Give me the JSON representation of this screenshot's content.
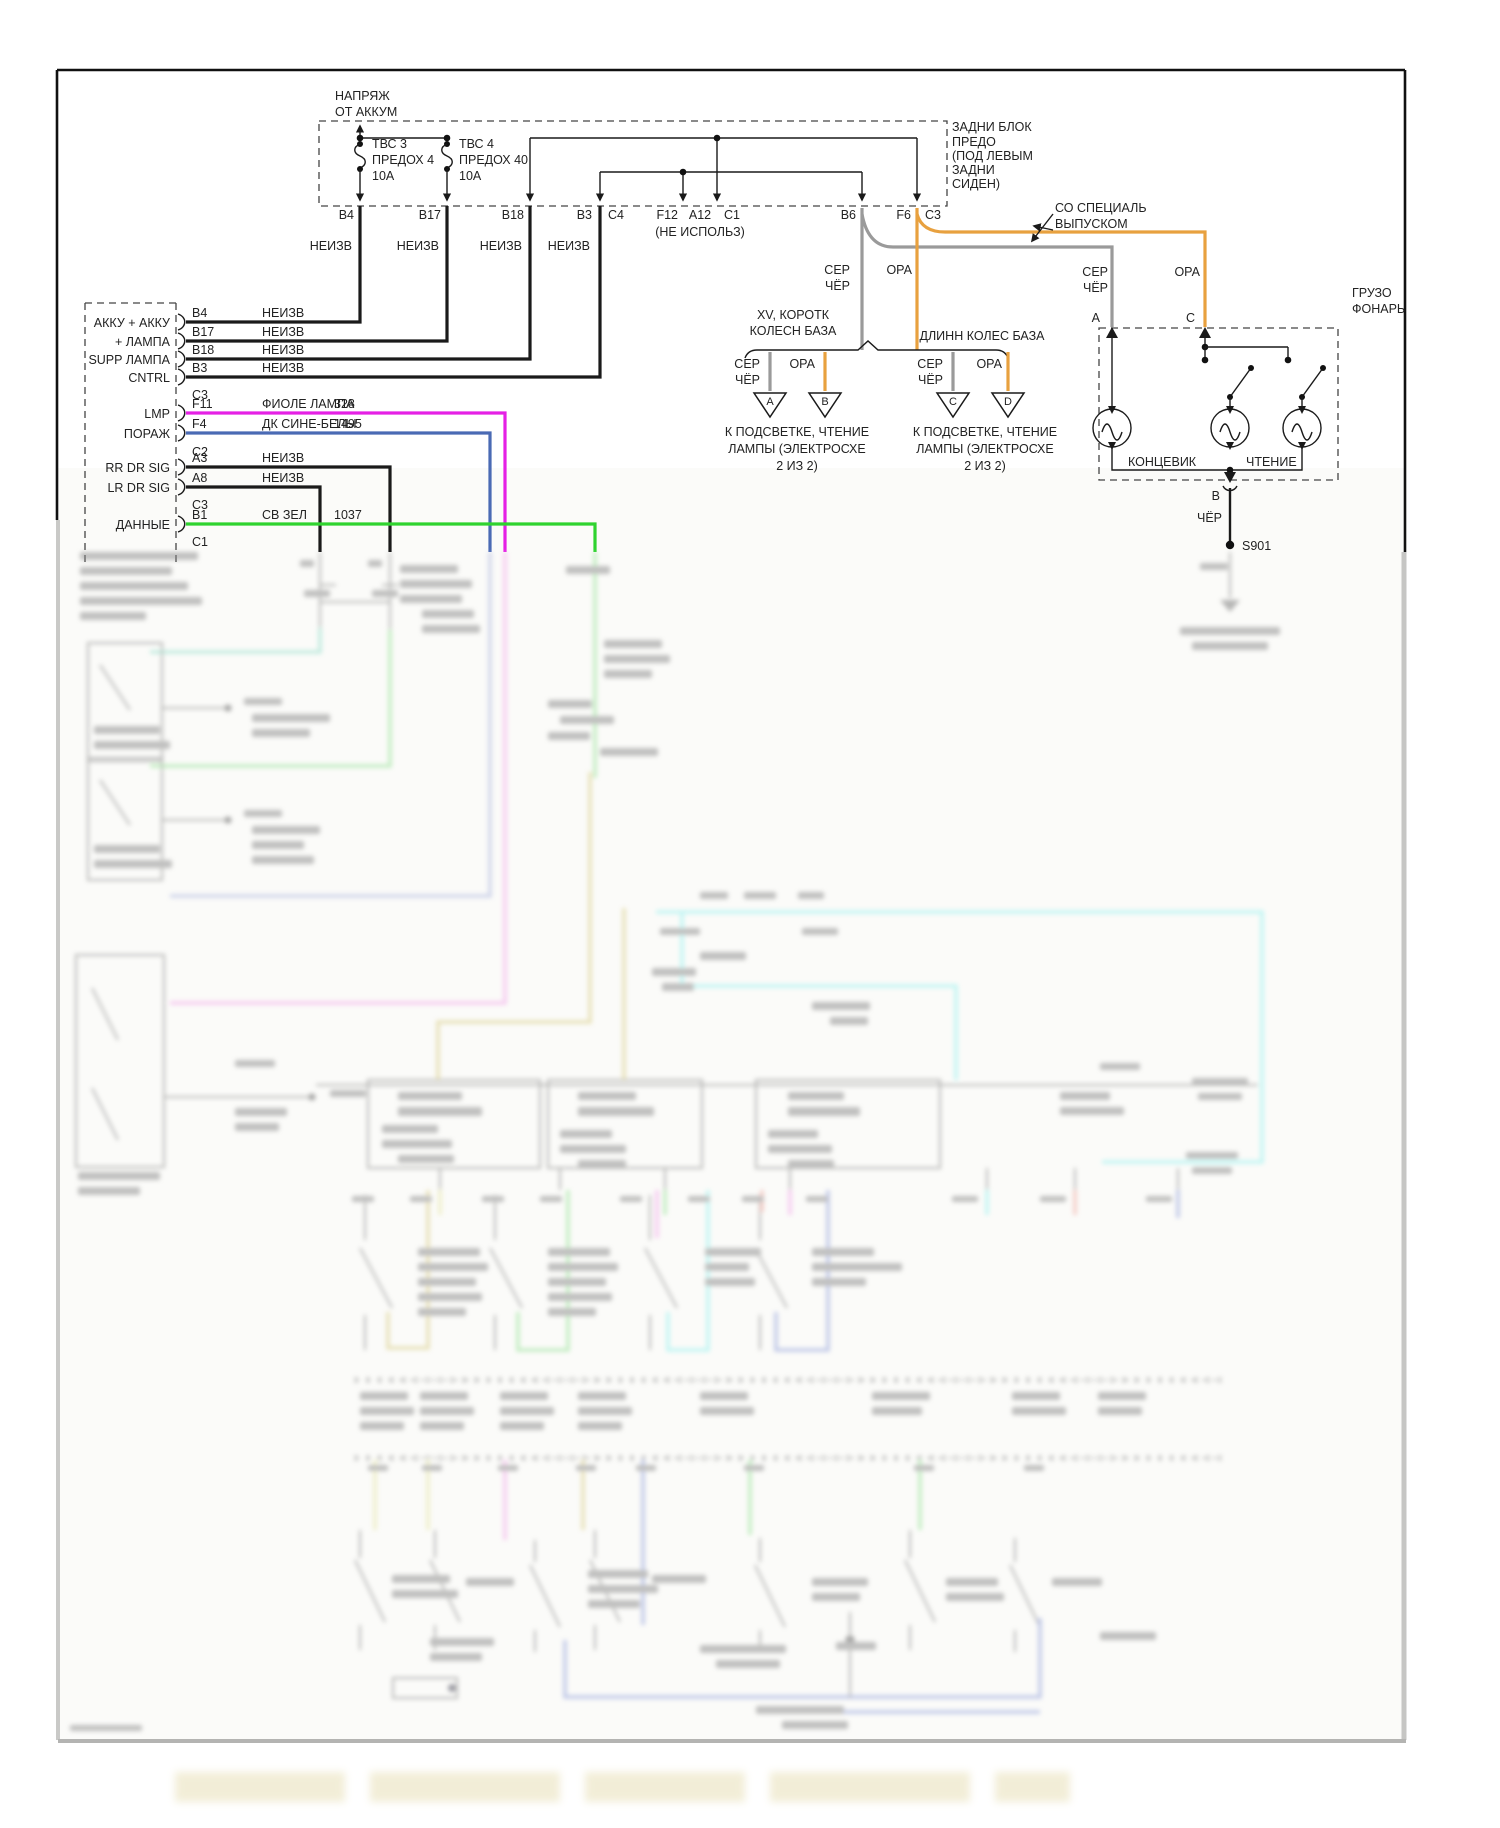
{
  "palette": {
    "orange": "#E8A13F",
    "gray_wire": "#9A9A9A",
    "magenta": "#E520E5",
    "blue": "#4A6AB4",
    "green": "#2FD32F",
    "teal": "#8FDCC8",
    "light_green": "#90E090",
    "lavender": "#A8B2DC",
    "pink": "#F2A0E8",
    "tan": "#D6C97E",
    "cyan": "#8FF0EE",
    "salmon": "#EFA49B",
    "periwinkle": "#8C9CD8",
    "pale_yellow": "#E4E4A0"
  },
  "fusebox": {
    "supply": [
      "НАПРЯЖ",
      "ОТ АККУМ"
    ],
    "title": [
      "ЗАДНИ БЛОК",
      "ПРЕДО",
      "(ПОД ЛЕВЫМ",
      "ЗАДНИ",
      "СИДЕН)"
    ],
    "fuse1": [
      "ТВС 3",
      "ПРЕДОХ 4",
      "10А"
    ],
    "fuse2": [
      "ТВС 4",
      "ПРЕДОХ 40",
      "10А"
    ],
    "pins": [
      "B4",
      "B17",
      "B18",
      "B3",
      "C4",
      "F12",
      "A12",
      "C1",
      "B6",
      "F6",
      "C3"
    ],
    "not_used": "(НЕ ИСПОЛЬЗ)",
    "unknown": "НЕИЗВ"
  },
  "module": {
    "rows": [
      {
        "label": "АККУ + АККУ",
        "pin": "B4",
        "wire": "НЕИЗВ",
        "circuit": ""
      },
      {
        "label": "+ ЛАМПА",
        "pin": "B17",
        "wire": "НЕИЗВ",
        "circuit": ""
      },
      {
        "label": "SUPP ЛАМПА",
        "pin": "B18",
        "wire": "НЕИЗВ",
        "circuit": ""
      },
      {
        "label": "CNTRL",
        "pin": "B3",
        "wire": "НЕИЗВ",
        "circuit": ""
      },
      {
        "label": "",
        "pin": "C3",
        "wire": "",
        "circuit": ""
      },
      {
        "label": "LMP",
        "pin": "F11",
        "wire": "ФИОЛЕ ЛАМПА",
        "circuit": "328"
      },
      {
        "label": "ПОРАЖ",
        "pin": "F4",
        "wire": "ДК СИНЕ-БЕЛЫ",
        "circuit": "1495"
      },
      {
        "label": "",
        "pin": "C2",
        "wire": "",
        "circuit": ""
      },
      {
        "label": "RR DR SIG",
        "pin": "A3",
        "wire": "НЕИЗВ",
        "circuit": ""
      },
      {
        "label": "LR DR SIG",
        "pin": "A8",
        "wire": "НЕИЗВ",
        "circuit": ""
      },
      {
        "label": "",
        "pin": "C3",
        "wire": "",
        "circuit": ""
      },
      {
        "label": "ДАННЫЕ",
        "pin": "B1",
        "wire": "СВ ЗЕЛ",
        "circuit": "1037"
      },
      {
        "label": "",
        "pin": "C1",
        "wire": "",
        "circuit": ""
      }
    ]
  },
  "labels": {
    "gray": [
      "СЕР",
      "ЧЁР"
    ],
    "orange": "ОРА"
  },
  "notes": {
    "special": [
      "СО СПЕЦИАЛЬ",
      "ВЫПУСКОМ"
    ],
    "short_wb": [
      "XV, КОРОТК",
      "КОЛЕСН БАЗА"
    ],
    "long_wb": "ДЛИНН КОЛЕС БАЗА",
    "dest": [
      "К ПОДСВЕТКЕ, ЧТЕНИЕ",
      "ЛАМПЫ (ЭЛЕКТРОСХЕ",
      "2 ИЗ 2)"
    ]
  },
  "connectors": {
    "a": "A",
    "b": "B",
    "c": "C",
    "d": "D"
  },
  "cargo": {
    "title": [
      "ГРУЗО",
      "ФОНАРЬ"
    ],
    "pin_a": "А",
    "pin_c": "С",
    "pin_b": "В",
    "courtesy": "КОНЦЕВИК",
    "reading": "ЧТЕНИЕ",
    "wire_black": "ЧЁР",
    "splice": "S901"
  }
}
